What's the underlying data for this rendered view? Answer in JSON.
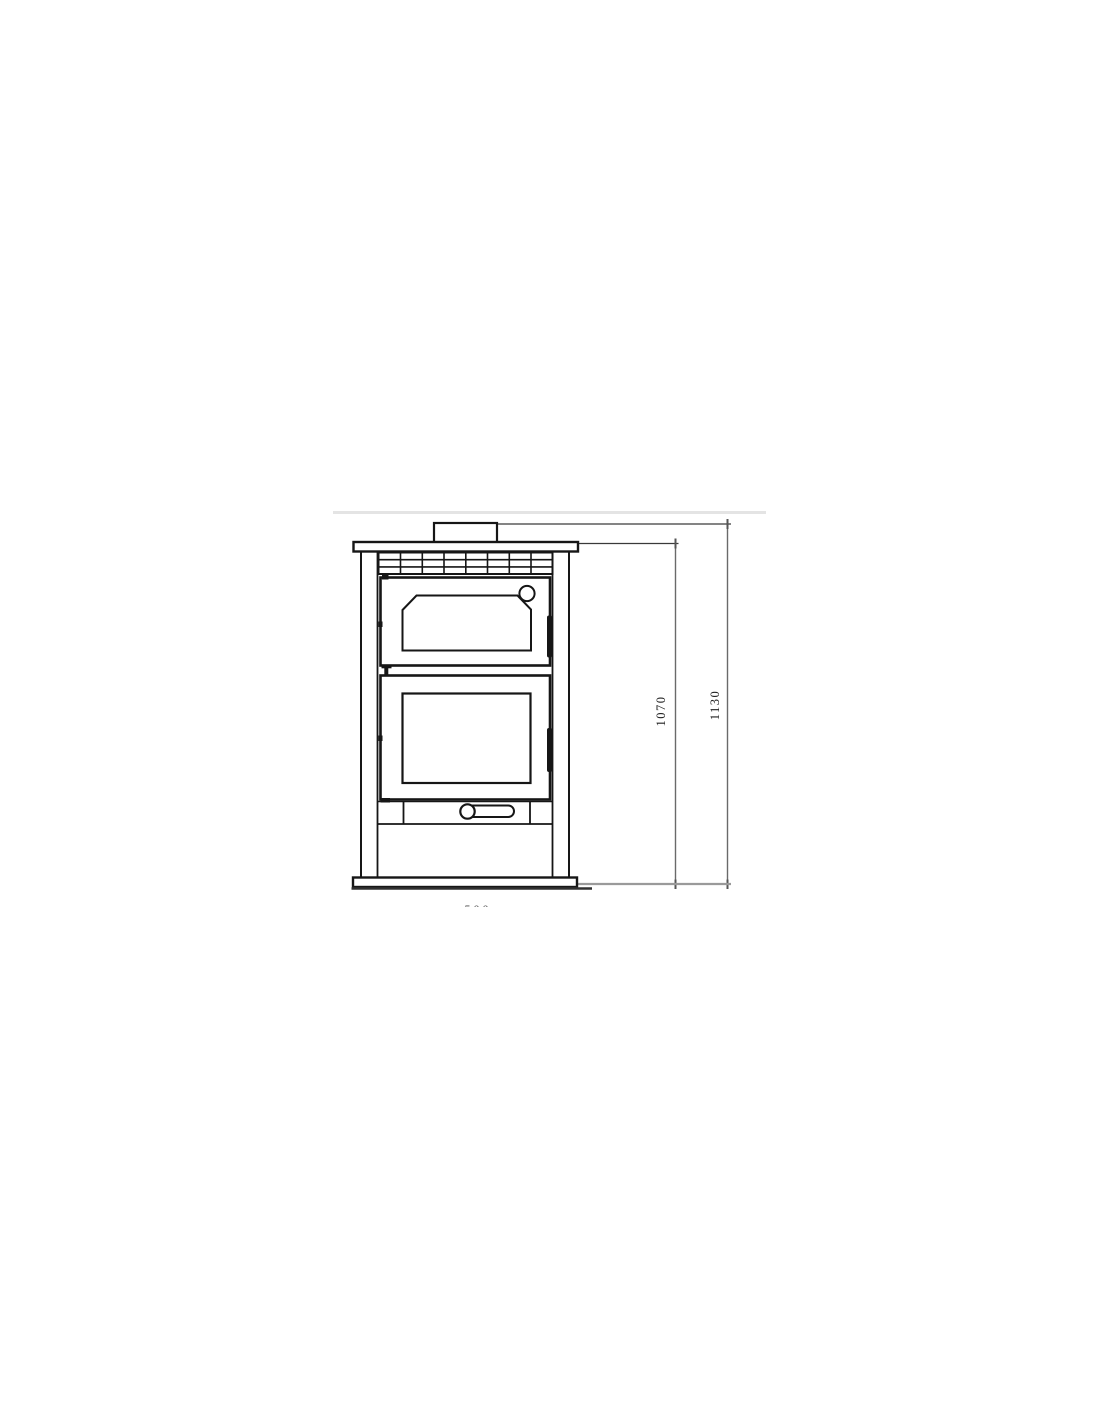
{
  "page": {
    "background": "#ffffff",
    "top_rule_color": "#e4e4e4"
  },
  "drawing": {
    "description": "front elevation technical drawing of a wood-burning stove with upper oven door, lower firebox door, ash drawer and flue collar",
    "line_color": "#161616",
    "dim_line_color": "#6a6a6a",
    "floor_baseline_color": "#9a9a9a"
  },
  "dims": {
    "height_to_top_plate": "1070",
    "height_overall": "1130",
    "width_bottom_cropped": "500"
  }
}
